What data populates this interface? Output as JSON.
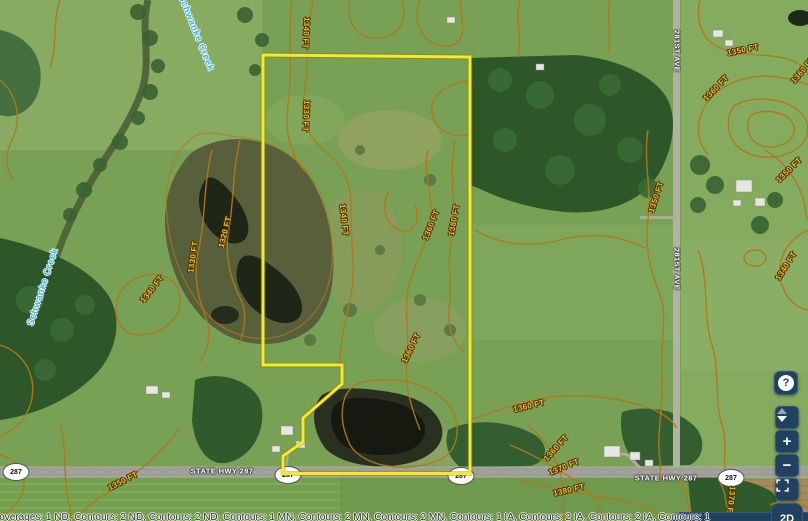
{
  "map": {
    "creek_labels": [
      "Schwanke Creek",
      "Schwanke Creek"
    ],
    "road_labels": [
      "281ST AVE",
      "281ST AVE",
      "STATE HWY 287",
      "STATE HWY 287"
    ],
    "highway_shields": [
      "287",
      "287",
      "287",
      "287"
    ],
    "contour_labels": [
      "1340 FT",
      "1330 FT",
      "1320 FT",
      "1330 FT",
      "1340 FT",
      "1340 FT",
      "1360 FT",
      "1380 FT",
      "1360 FT",
      "1360 FT",
      "1350 FT",
      "1360 FT",
      "1350 FT",
      "1350 FT",
      "1340 FT",
      "1350 FT",
      "1360 FT",
      "1370 FT",
      "1380 FT",
      "1370 FT",
      "1360 FT"
    ],
    "colors": {
      "parcel_boundary": "#f9e825",
      "contour_line": "#b0791a",
      "contour_label": "#f2bd31",
      "creek_label": "#3db4e8",
      "road_label": "#ffffff",
      "toolbar": "#20415f"
    }
  },
  "controls": {
    "help": "?",
    "zoom_in": "+",
    "zoom_out": "−",
    "view_mode": "2D"
  },
  "attribution": "Coverages: 1 ND, Contours: 2 ND, Contours: 2 ND, Contours: 1 MN, Contours: 2 MN, Contours: 2 MN, Contours: 1 IA, Contours: 2 IA, Contours: 2 IA, Contours: 1"
}
